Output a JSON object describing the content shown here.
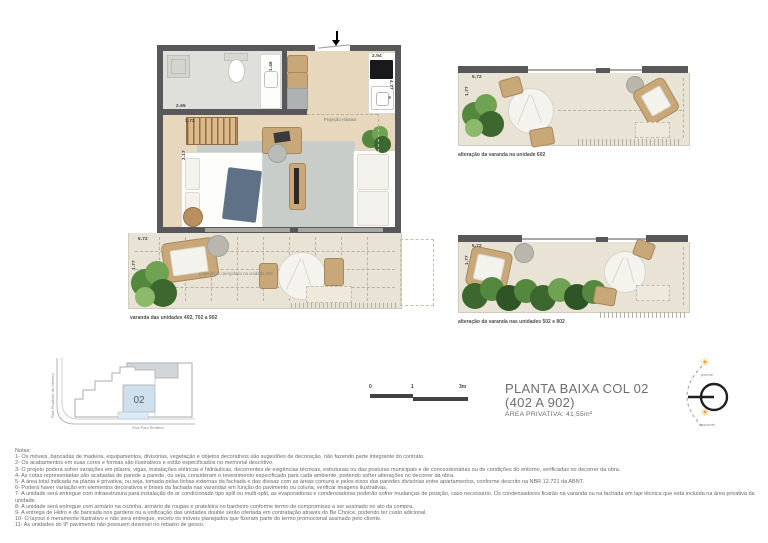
{
  "title_block": {
    "line1": "PLANTA BAIXA COL 02",
    "line2": "(402 A 902)",
    "area_label": "ÁREA PRIVATIVA:",
    "area_value": "41,55m²"
  },
  "main_plan": {
    "dims": {
      "bathroom_width": "2.65",
      "stairs_width": "1.73",
      "room_depth": "3.17",
      "hall_width": "1.46",
      "kitchen_width": "2.94",
      "kitchen_depth": "4.77"
    },
    "labels": {
      "ceiling_projection": "Projeção rebaixo"
    }
  },
  "lower_balcony": {
    "dims": {
      "width": "5.72",
      "depth": "1.77"
    },
    "pergola_label": "projeção do pergolado na unidade 902",
    "caption": "varanda das unidades 402, 702 a 902"
  },
  "balcony_602": {
    "dims": {
      "width": "5,72",
      "depth": "1,77"
    },
    "caption": "alteração da varanda na unidade 602"
  },
  "balcony_502_802": {
    "dims": {
      "width": "5,72",
      "depth": "1,77"
    },
    "caption": "alteração da varanda nas unidades 502 e 802"
  },
  "key_plan": {
    "unit_number": "02",
    "street_left": "Rua Prudente de Moraes",
    "street_bottom": "Rua Paul Redfern"
  },
  "scale_bar": {
    "tick0": "0",
    "tick1": "1",
    "tick3": "3m"
  },
  "compass": {
    "top_label": "poente",
    "bottom_label": "nascente"
  },
  "notes": {
    "heading": "Notas:",
    "items": [
      "1- Os móveis, bancadas de madeira, equipamentos, divisórias, vegetação e objetos decorativos são sugestões de decoração, não fazendo parte integrante do contrato.",
      "2- Os acabamentos em suas cores e formas são ilustrativos e estão especificados no memorial descritivo.",
      "3- O projeto poderá sofrer variações em pilares, vigas, instalações elétricas e hidráulicas, decorrentes de exigências técnicas, estruturais ou das posturas municipais e de concessionárias ou de condições do entorno, verificadas no decorrer da obra.",
      "4- As cotas representadas são acabadas de parede a parede, ou seja, consideram o revestimento especificado para cada ambiente, podendo sofrer alterações no decorrer da obra.",
      "5- A área total indicada na planta é privativa, ou seja, tomada pelas linhas externas da fachada e das divisas com as áreas comuns e pelos eixos das paredes divisórias entre apartamentos, conforme descrito na NBR 12.721 da ABNT.",
      "6- Poderá haver variação em elementos decorativos e brises da fachada nas varandas em função do pavimento ou coluna, verificar imagens ilustrativas.",
      "7- A unidade será entregue com infraestrutura para instalação de ar condicionado tipo split ou multi-split, as evaporadoras e condensadoras poderão sofrer mudanças de posição, caso necessário. Os condensadores ficarão na varanda ou na fachada em laje técnica que está incluída na área privativa da unidade.",
      "8- A unidade será entregue com armário na cozinha, armário de roupas e prateleira no banheiro conforme termo de compromisso a ser assinado no ato da compra.",
      "9- A entrega de Hidro e de bancada nos gardens ou a unificação das unidades double serão ofertada em contratação através do Be Choice, podendo ter custo adicional.",
      "10- O layout é meramente ilustrativo e não será entregue, exceto os móveis planejados que fizeram parte do termo promocional assinado pelo cliente.",
      "11- As unidades do 9º pavimento não possuem desnível no rebaixo de gesso."
    ]
  }
}
